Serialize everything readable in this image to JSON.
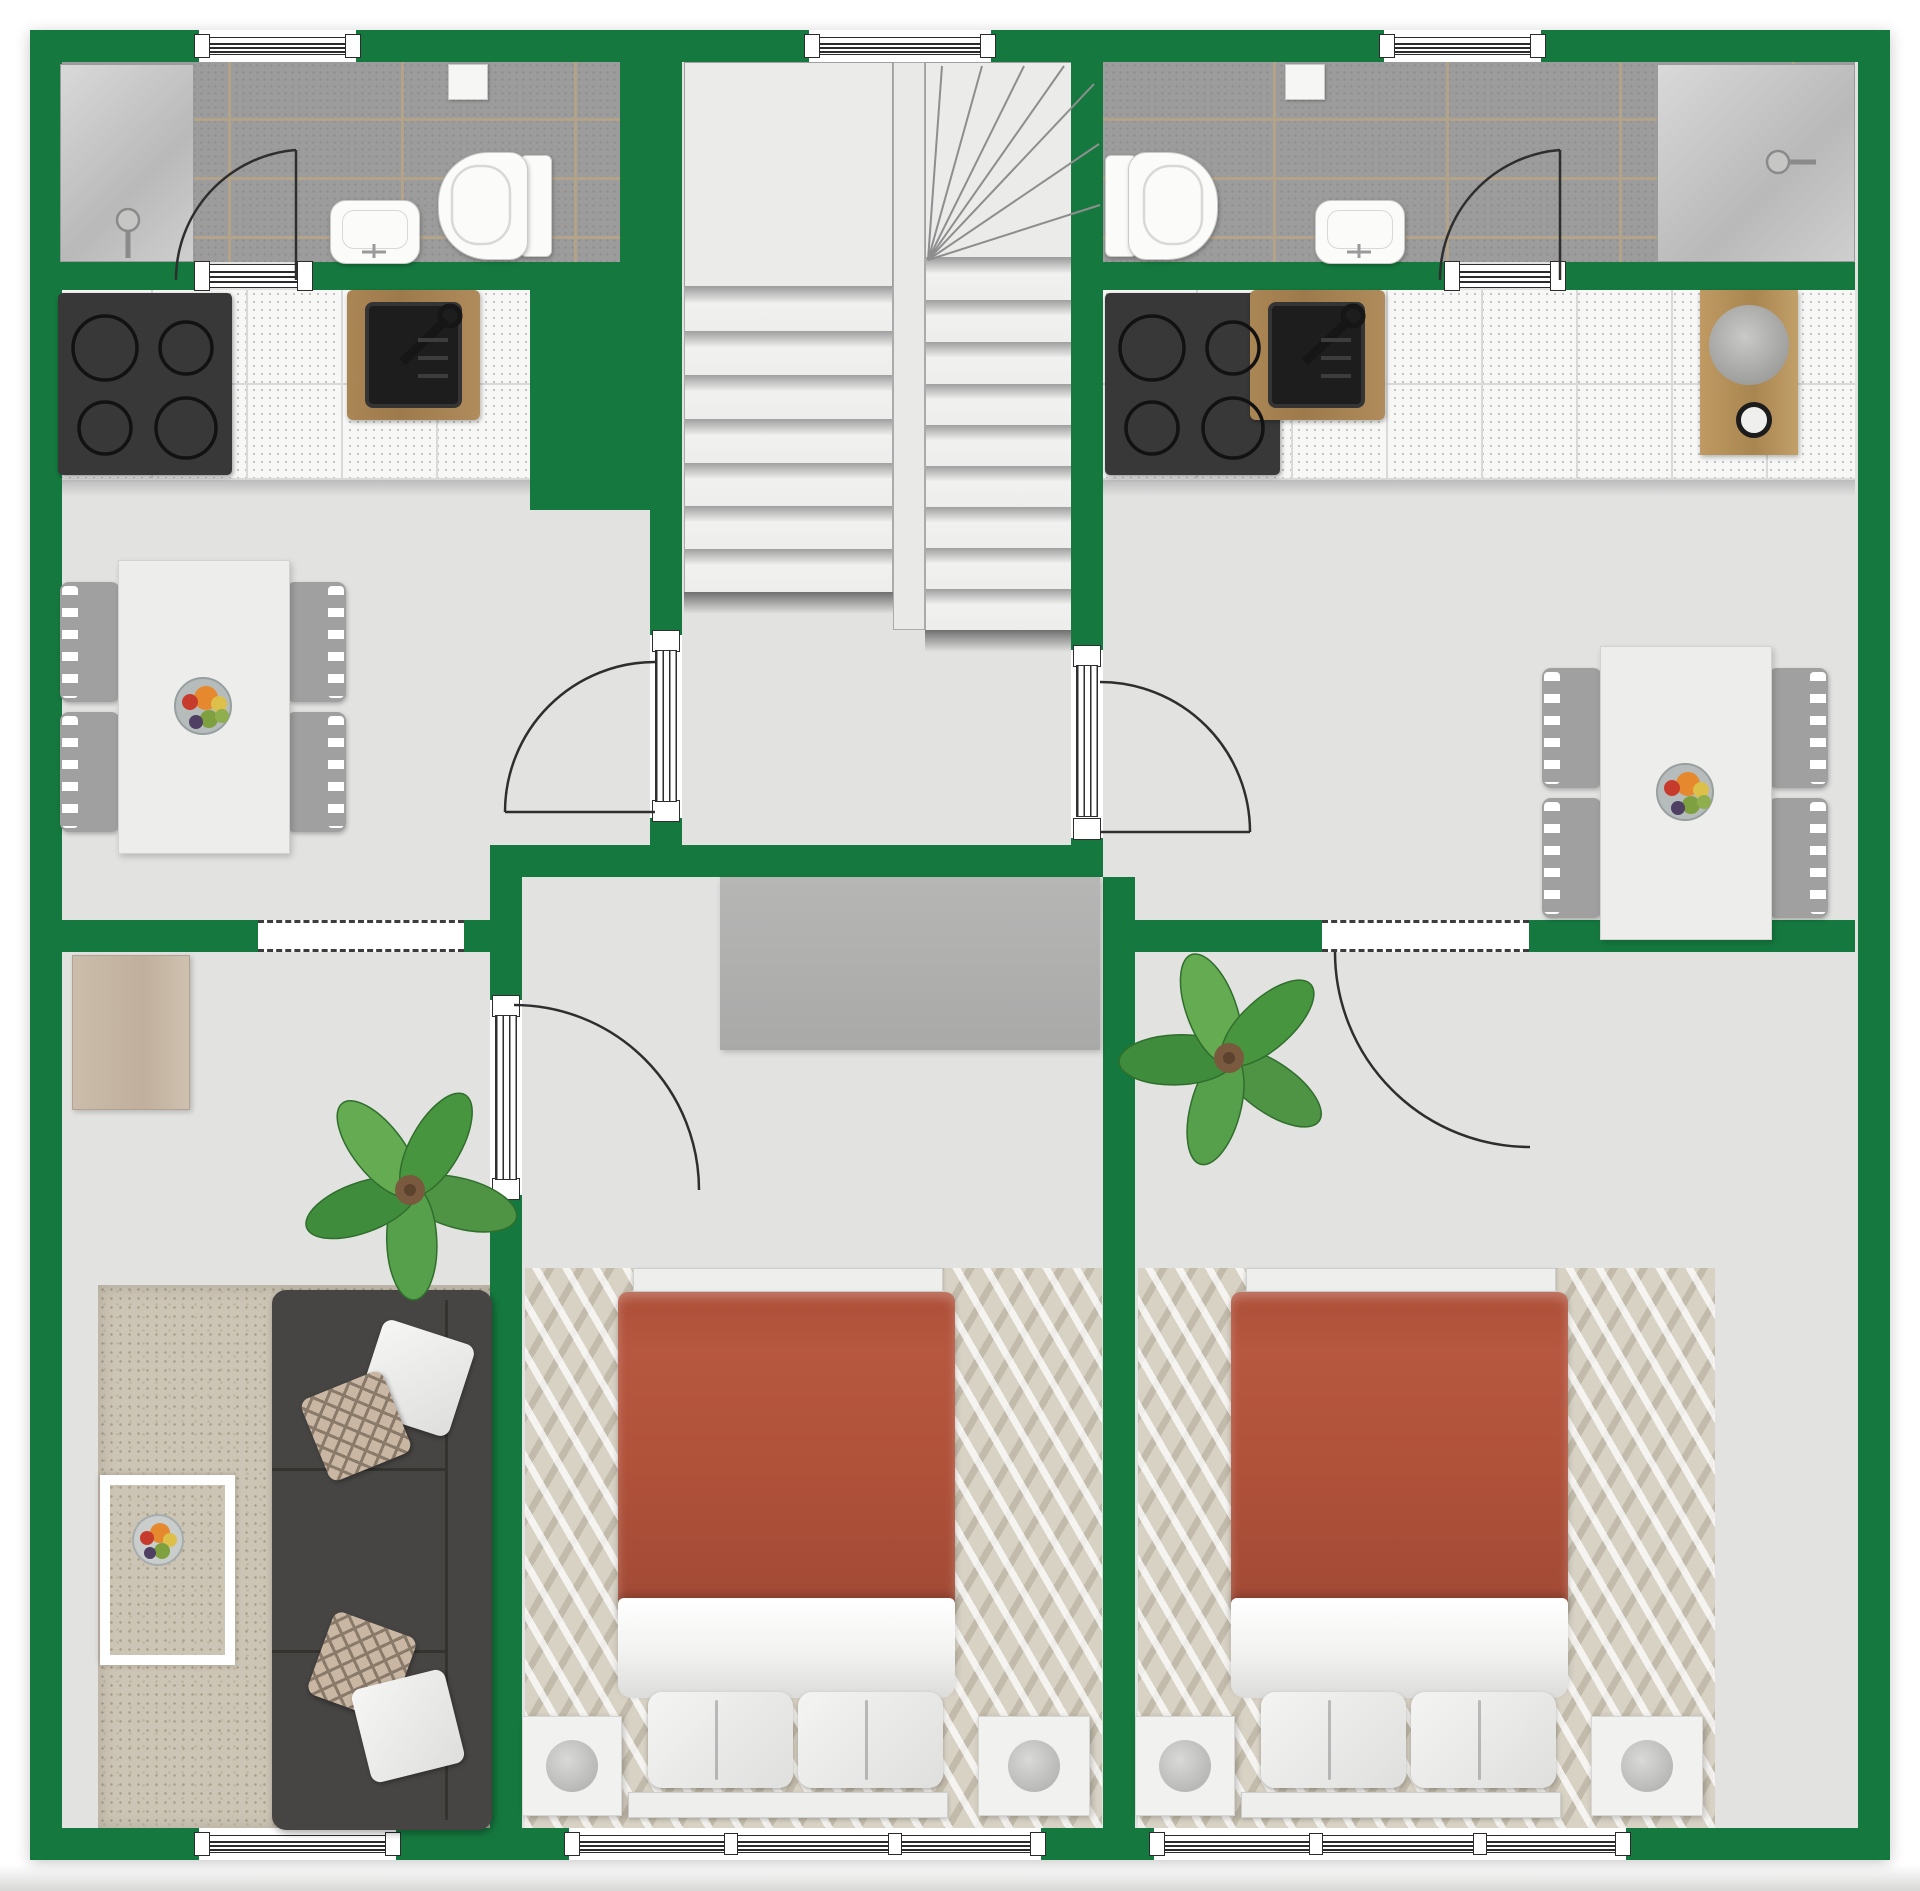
{
  "document": {
    "kind": "floor-plan",
    "view": "top-down 2D render",
    "visible_text": "none"
  },
  "palette": {
    "wall_green": "#15793f",
    "floor_gray": "#e2e2e1",
    "bathroom_tile": "#9c9c9c",
    "tile_grout": "#b3a489",
    "kitchen_tile_white": "#f7f7f6",
    "counter_wood": "#a58052",
    "vanity_wood": "#b98e58",
    "cooktop_black": "#383838",
    "sofa_charcoal": "#474543",
    "living_rug_beige": "#ccc4b4",
    "bedroom_rug": "#d8d2c5",
    "bed_duvet_terracotta": "#b0513a",
    "linen_white": "#f2f2f1",
    "sideboard_beige": "#c7b7a6",
    "wardrobe_gray": "#b0b0b0",
    "plant_green": "#4e9444",
    "door_line": "#2e2e2e"
  },
  "rooms": [
    {
      "name": "bathroom-left",
      "fixtures": [
        "shower",
        "sink",
        "toilet",
        "toilet-paper-holder",
        "door"
      ]
    },
    {
      "name": "stair-hall",
      "fixtures": [
        "landing",
        "straight-flight",
        "winder-flight",
        "entry-door-left",
        "entry-door-right"
      ]
    },
    {
      "name": "bathroom-right",
      "fixtures": [
        "toilet",
        "sink",
        "shower",
        "toilet-paper-holder",
        "door"
      ]
    },
    {
      "name": "kitchen-left",
      "fixtures": [
        "cooktop-4-burners",
        "counter",
        "cutting-board-sink",
        "faucet"
      ]
    },
    {
      "name": "kitchen-right",
      "fixtures": [
        "cooktop-4-burners",
        "counter",
        "cutting-board-sink",
        "faucet",
        "wood-vanity-round-basin"
      ]
    },
    {
      "name": "dining-left",
      "fixtures": [
        "table",
        "chairs-x4",
        "fruit-bowl"
      ]
    },
    {
      "name": "dining-right",
      "fixtures": [
        "table",
        "chairs-x4",
        "fruit-bowl"
      ]
    },
    {
      "name": "living-room-left",
      "fixtures": [
        "sideboard",
        "plant",
        "area-rug",
        "sofa",
        "pillows-x4",
        "coffee-table",
        "fruit-bowl"
      ]
    },
    {
      "name": "bedroom-middle",
      "fixtures": [
        "wardrobe",
        "rug",
        "double-bed",
        "pillows-x2",
        "nightstand-x2",
        "lamps"
      ]
    },
    {
      "name": "bedroom-right",
      "fixtures": [
        "plant",
        "rug",
        "double-bed",
        "pillows-x2",
        "nightstand-x2",
        "lamps"
      ]
    }
  ],
  "stairs": {
    "left_flight_treads": 7,
    "winder_steps": 7,
    "right_flight_treads": 9
  },
  "windows": {
    "top_wall": 3,
    "bottom_wall_groups": 3,
    "bottom_wall_panes": 7
  },
  "doors": {
    "swing_doors": 6,
    "dashed_pass_throughs": 2
  },
  "beds": {
    "count": 2,
    "duvet_color_name": "terracotta"
  },
  "plants": {
    "count": 2,
    "type": "monstera"
  }
}
